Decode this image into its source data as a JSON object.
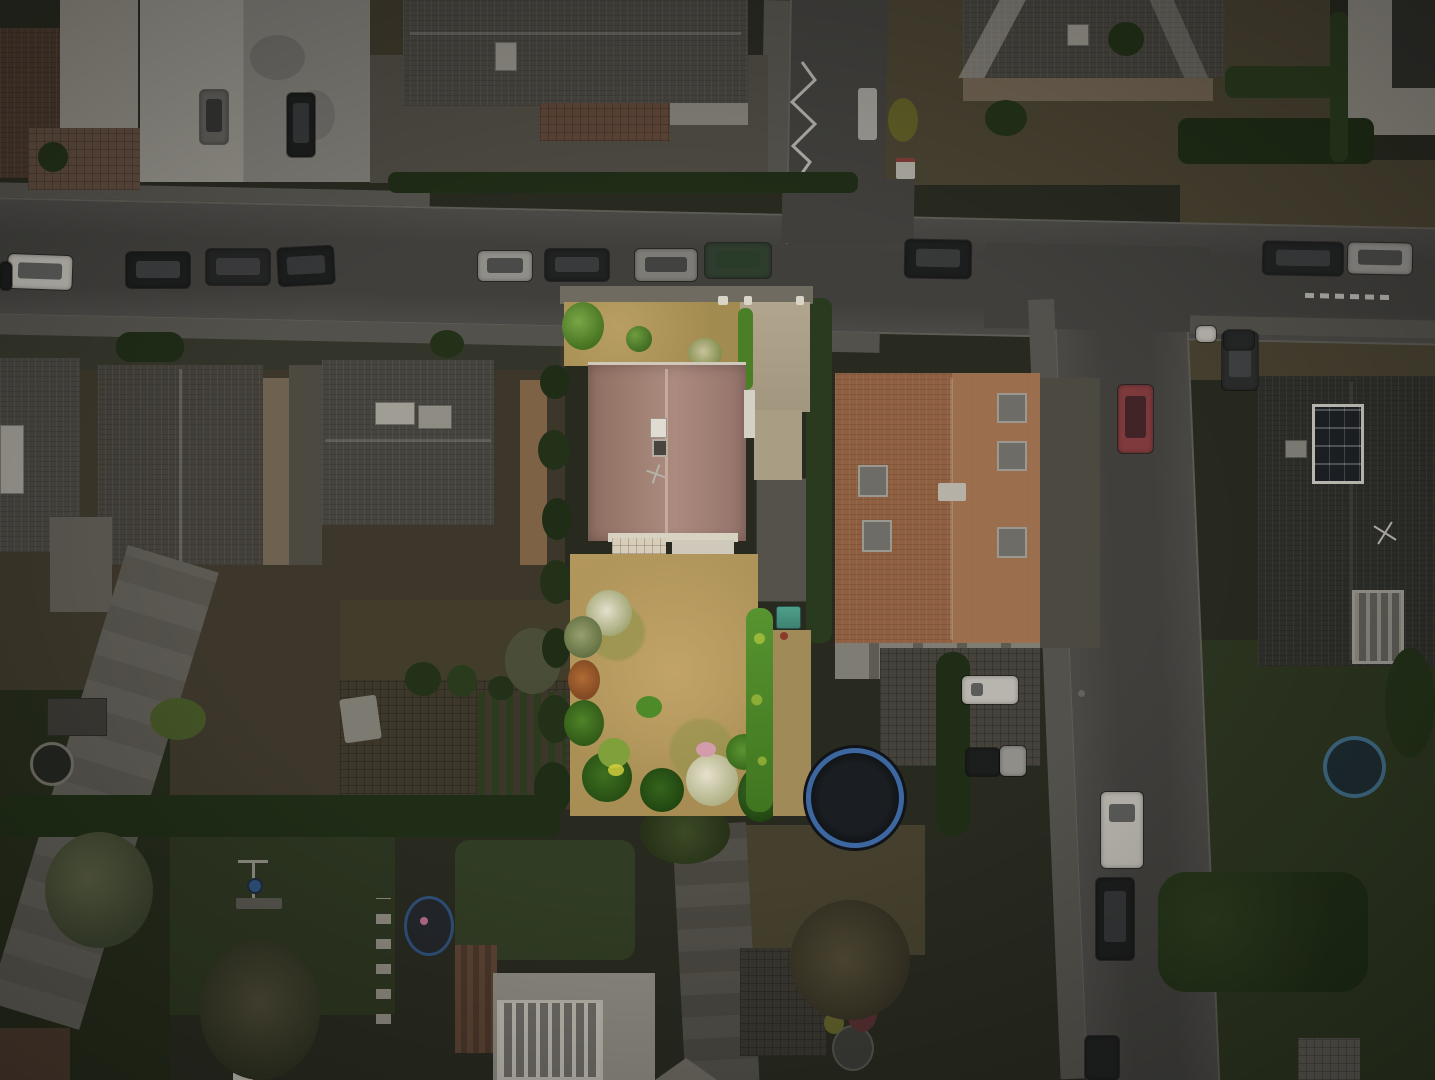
{
  "meta": {
    "type": "aerial-drone-photograph",
    "width_px": 1435,
    "height_px": 1080,
    "description": "Top-down aerial photo of a suburban residential neighborhood at dusk. The entire scene is dimmed except one brightly highlighted property parcel near the center: a detached house with a pink-brown tiled roof, a paved terrace, a dry yellow lawn garden ringed by green and flowering shrubs, and a gravel driveway."
  },
  "scene": {
    "highlighted_property": {
      "label": "highlighted parcel",
      "house": "hip-roof house with pink-brown tiles, white chimney, roof window and antenna",
      "garden": "dry tan lawn with green patches, flowering white and pink shrubs, bright green hedge, orange-red bush, teal storage boxes",
      "driveway": "light gravel driveway on the north-east side",
      "terrace": "cream paved terrace south of the house"
    },
    "streets": {
      "main_street": "horizontal street across the image with parallel-parked cars on both segments",
      "north_street": "street entering from top with white zigzag road marking",
      "east_street": "street curving down the right side with parked cars",
      "road_markings": [
        "white zigzag line",
        "white guardrail dashes"
      ]
    },
    "surroundings": [
      "white flat-roof building top-left with parked cars in forecourt",
      "gray hip-roof houses left-middle with beige side walls",
      "large tan-orange roofed apartment house right of the highlighted parcel with roof windows",
      "dark roofed house far right with two solar panel arrays and glass conservatory",
      "vegetable garden plots lower-left with greenhouse tarp",
      "bottom house with glazed conservatory roof and brown pergola",
      "green lawn bottom-left with swing set and stepping-stone path"
    ],
    "objects": {
      "parked_cars_total_visible": 21,
      "car_colors": [
        "white",
        "silver",
        "black",
        "dark-green",
        "red"
      ],
      "trampoline": "dark trampoline with blue rim right of the highlighted garden",
      "hot_tub": "round dark hot tub with blue cover bottom-left house",
      "round_pool": "small dark round pool in right-hand garden",
      "fire_pit_ring": "light ring object in left garden"
    }
  },
  "palette": {
    "ground": "#282a20",
    "soil": "#3c372a",
    "lawnDark": "#2c3520",
    "lawnDry": "#474130",
    "gravel": "#4c4941",
    "street": "#403f3c",
    "streetLight": "#4a4946",
    "sidewalk": "#53514b",
    "curb": "#5d5b55",
    "roofGray": "#46443e",
    "roofGrayLight": "#585349",
    "roofDark": "#2f2f2b",
    "roofWhite": "#7f7d75",
    "roofBrown": "#47372c",
    "roofOrange": "#8e6041",
    "roofOrangeLight": "#9e7250",
    "wallWhite": "#8b887f",
    "wallBeige": "#6e6150",
    "wallTan": "#7d6245",
    "hedge": "#2a3a1e",
    "hedgeDark": "#1f2c16",
    "tree": "#233118",
    "treePale": "#4c523c",
    "carWhite": "#b7b5ad",
    "carSilver": "#908e89",
    "carBlack": "#1c1d1d",
    "carGreen": "#2e3d2e",
    "carRed": "#7e3a3c",
    "marking": "#cfcdc6",
    "hlLawn": "#b49a5e",
    "hlLawnGreen": "#7f8f45",
    "hlRoof": "#a08078",
    "hlRoofDark": "#85665c",
    "hlRidge": "#c9b2a6",
    "hlTerrace": "#d8cdb8",
    "hlDriveway": "#b2a58d",
    "hlHedge": "#4a7f28",
    "hlHedgeBright": "#78aa3c",
    "hlBushDark": "#2d5a19",
    "hlBushGreen": "#4f8a28",
    "hlBushOrange": "#a05c2c",
    "flowerWhite": "#e6e0cc",
    "flowerPink": "#d29cab",
    "tealBox": "#3f8274",
    "trampoline": "#121518",
    "trampolineRing": "#3c67a0",
    "hotTubBlue": "#2f4f78",
    "panelDark": "#1e2125",
    "panelFrame": "#c9c6bd"
  }
}
